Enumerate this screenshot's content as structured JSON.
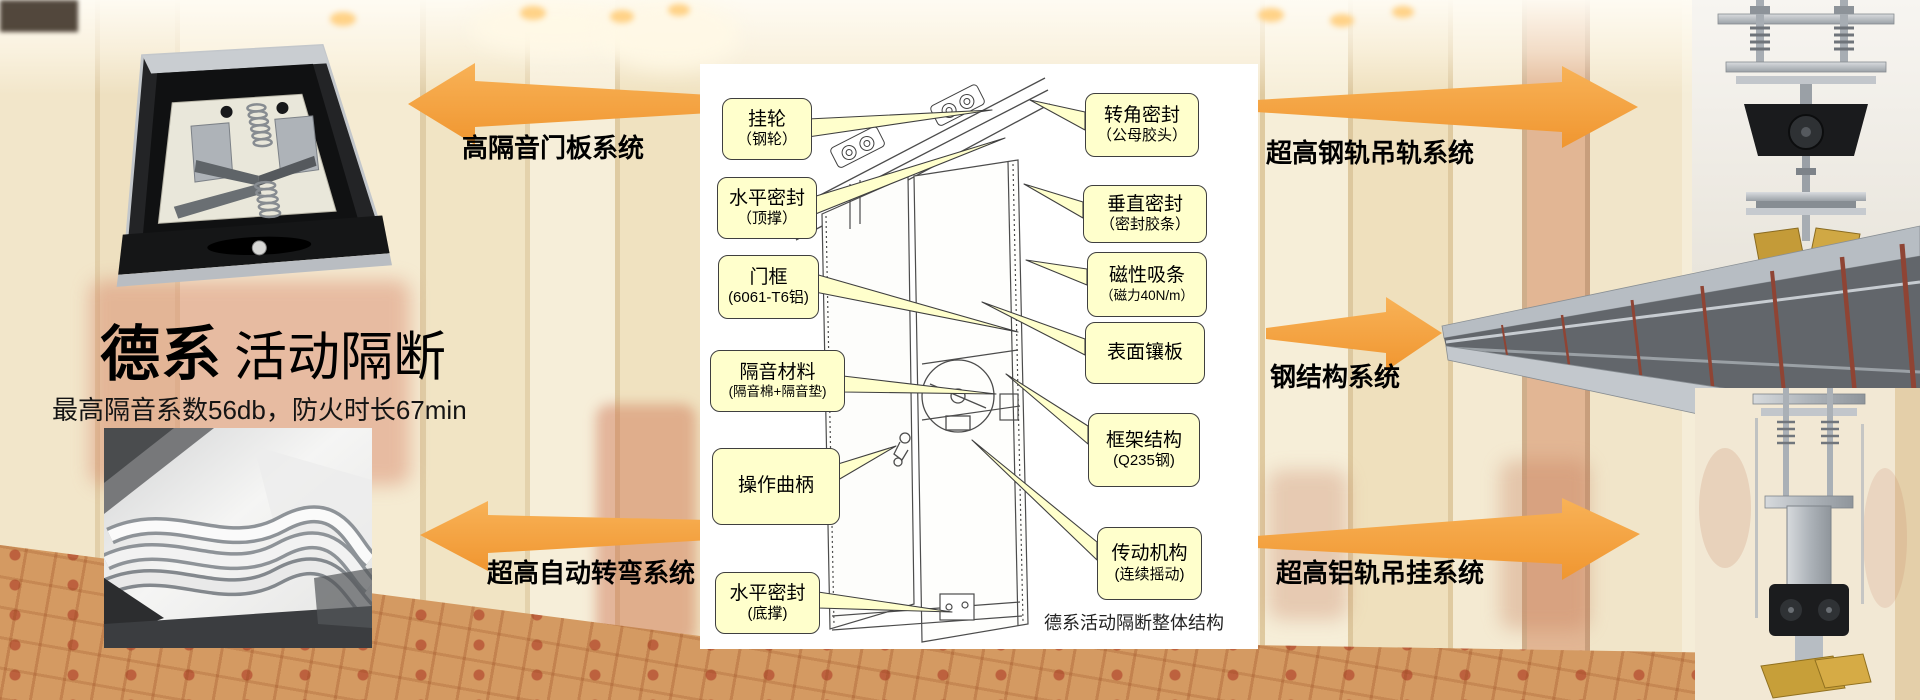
{
  "hero": {
    "title_bold": "德系",
    "title_regular": "活动隔断",
    "subtitle": "最高隔音系数56db，防火时长67min"
  },
  "arrow_labels": {
    "left_top": "高隔音门板系统",
    "left_bottom": "超高自动转弯系统",
    "right_top": "超高钢轨吊轨系统",
    "right_middle": "钢结构系统",
    "right_bottom": "超高铝轨吊挂系统"
  },
  "diagram": {
    "caption": "德系活动隔断整体结构",
    "left_callouts": [
      {
        "line1": "挂轮",
        "line2": "（钢轮）"
      },
      {
        "line1": "水平密封",
        "line2": "（顶撑）"
      },
      {
        "line1": "门框",
        "line2": "(6061-T6铝)"
      },
      {
        "line1": "隔音材料",
        "line2": "(隔音棉+隔音垫)"
      },
      {
        "line1": "操作曲柄",
        "line2": ""
      },
      {
        "line1": "水平密封",
        "line2": "(底撑)"
      }
    ],
    "right_callouts": [
      {
        "line1": "转角密封",
        "line2": "（公母胶头）"
      },
      {
        "line1": "垂直密封",
        "line2": "（密封胶条）"
      },
      {
        "line1": "磁性吸条",
        "line2": "（磁力40N/m）"
      },
      {
        "line1": "表面镶板",
        "line2": ""
      },
      {
        "line1": "框架结构",
        "line2": "(Q235钢)"
      },
      {
        "line1": "传动机构",
        "line2": "(连续摇动)"
      }
    ]
  },
  "colors": {
    "arrow_orange": "#F5A33C",
    "callout_fill": "#FFFFCC",
    "callout_border": "#3F3F3F",
    "label_text": "#000000"
  }
}
